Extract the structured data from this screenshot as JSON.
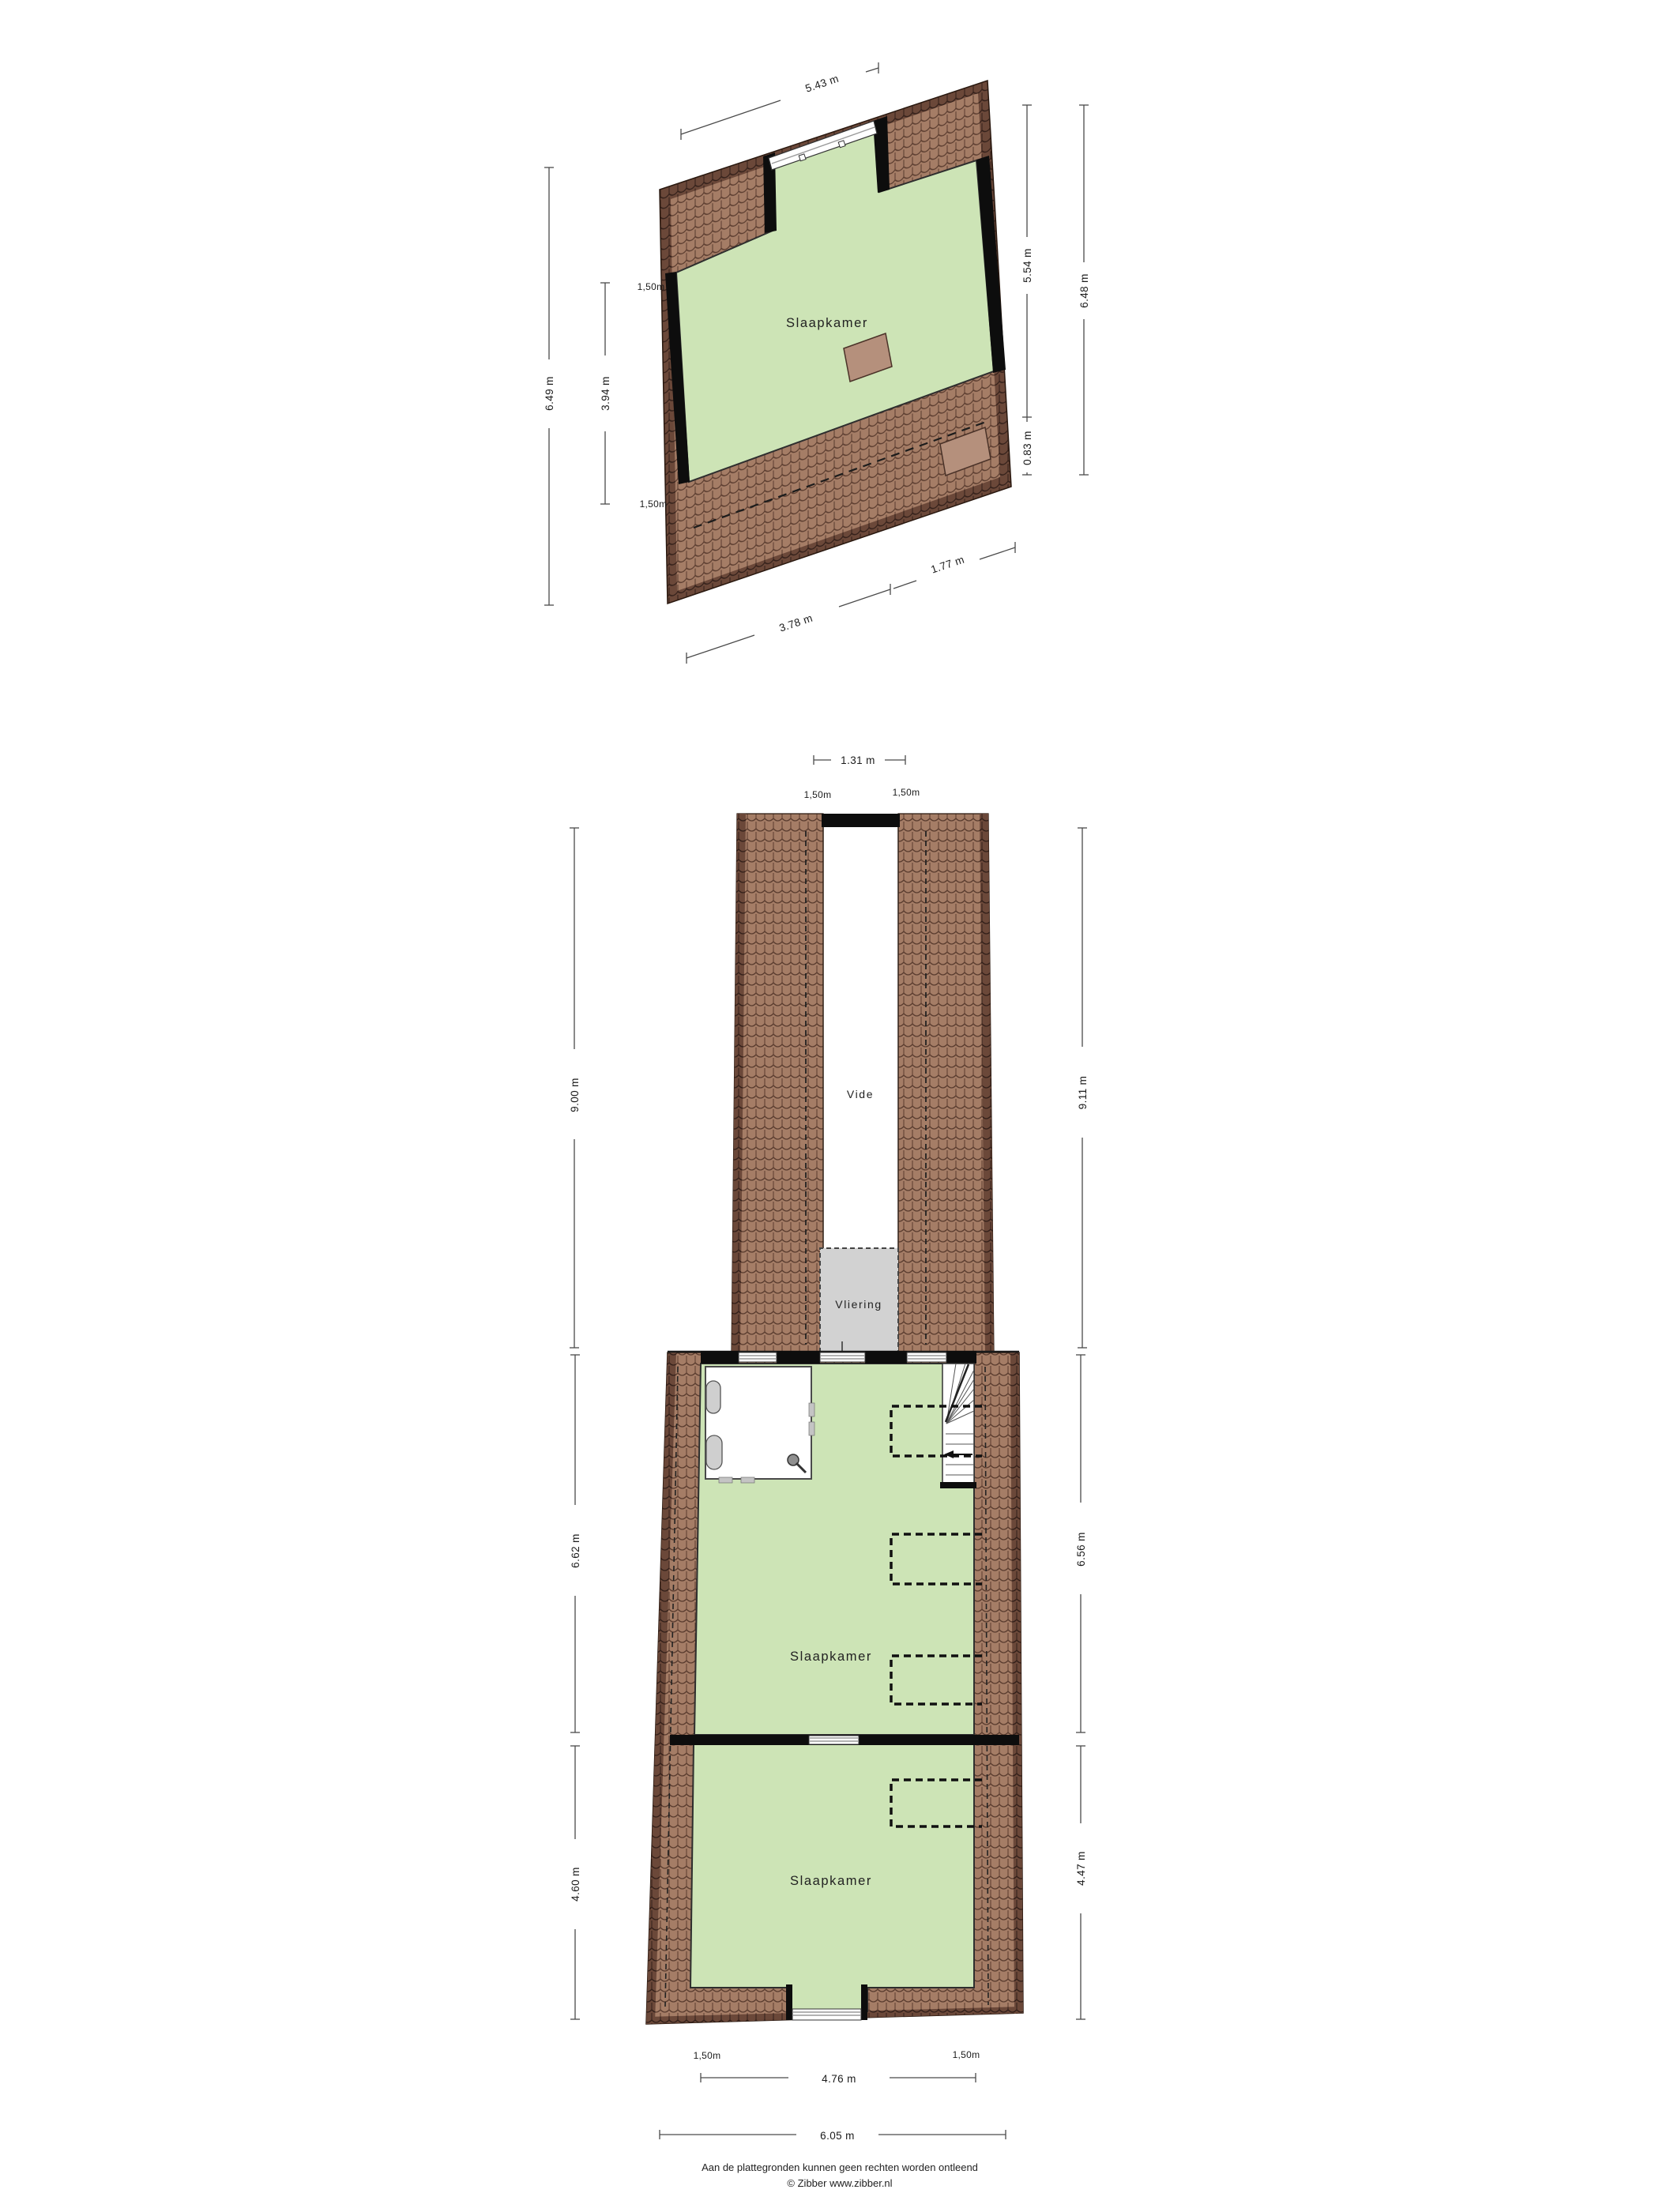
{
  "colors": {
    "roof_light": "#a57d66",
    "roof_dark": "#6b4839",
    "floor_green": "#cde4b6",
    "wall": "#0d0d0d",
    "vliering_gray": "#d2d2d2",
    "window_stripe": "#9a9a9a",
    "dimension_line": "#4a4a4a"
  },
  "floor_top": {
    "room_label": "Slaapkamer",
    "dimensions": {
      "top_width": "5.43 m",
      "left_total": "6.49 m",
      "left_roof_top": "1,50m",
      "left_room": "3.94 m",
      "left_roof_bottom": "1,50m",
      "right_room": "5.54 m",
      "right_total": "6.48 m",
      "right_roof": "0.83 m",
      "bottom_left": "3.78 m",
      "bottom_right": "1.77 m"
    }
  },
  "floor_bottom": {
    "vide_label": "Vide",
    "vliering_label": "Vliering",
    "bedroom_mid_label": "Slaapkamer",
    "bedroom_bottom_label": "Slaapkamer",
    "dimensions": {
      "vide_width": "1.31 m",
      "vide_left_headroom": "1,50m",
      "vide_right_headroom": "1,50m",
      "upper_left_height": "9.00 m",
      "upper_right_height": "9.11 m",
      "mid_left_height": "6.62 m",
      "mid_right_height": "6.56 m",
      "lower_left_height": "4.60 m",
      "lower_right_height": "4.47 m",
      "bottom_left_headroom": "1,50m",
      "bottom_right_headroom": "1,50m",
      "bottom_inner_width": "4.76 m",
      "bottom_outer_width": "6.05 m"
    }
  },
  "footer": {
    "disclaimer": "Aan de plattegronden kunnen geen rechten worden ontleend",
    "credit": "© Zibber www.zibber.nl"
  }
}
